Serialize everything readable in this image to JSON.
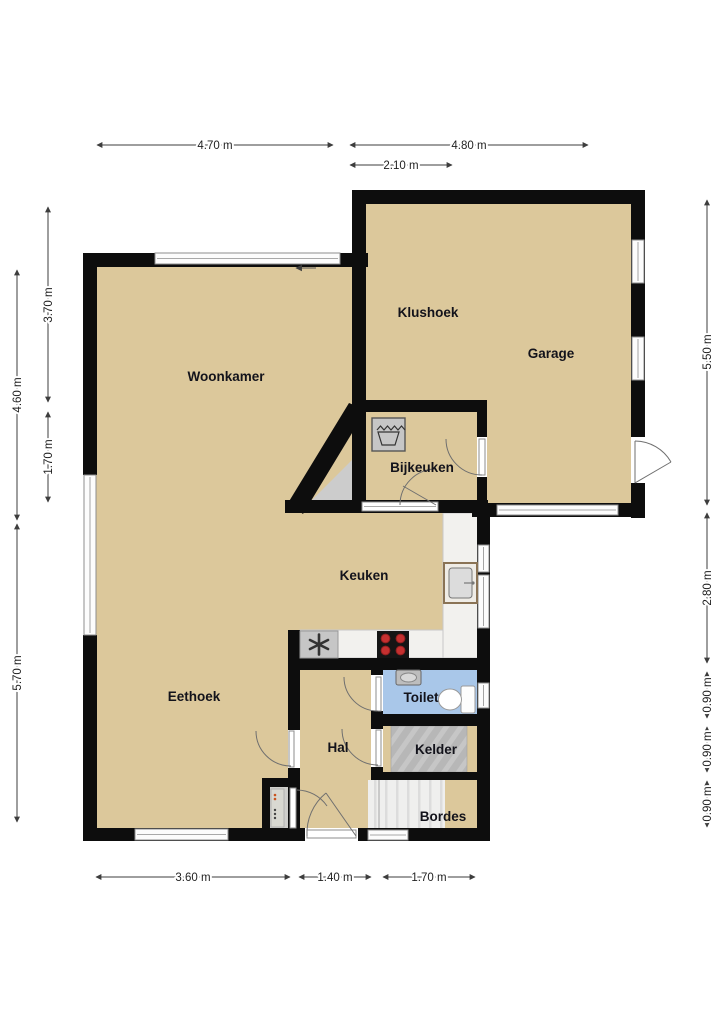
{
  "floor_plan": {
    "rooms": {
      "woonkamer": {
        "label": "Woonkamer"
      },
      "klushoek": {
        "label": "Klushoek"
      },
      "garage": {
        "label": "Garage"
      },
      "bijkeuken": {
        "label": "Bijkeuken"
      },
      "keuken": {
        "label": "Keuken"
      },
      "eethoek": {
        "label": "Eethoek"
      },
      "toilet": {
        "label": "Toilet"
      },
      "hal": {
        "label": "Hal"
      },
      "kelder": {
        "label": "Kelder"
      },
      "bordes": {
        "label": "Bordes"
      }
    },
    "dimensions": {
      "top": [
        {
          "label": "4.70 m"
        },
        {
          "label": "4.80 m"
        },
        {
          "label": "2.10 m"
        }
      ],
      "left_outer": [
        {
          "label": "4.60 m"
        },
        {
          "label": "5.70 m"
        }
      ],
      "left_inner": [
        {
          "label": "3.70 m"
        },
        {
          "label": "1.70 m"
        }
      ],
      "right": [
        {
          "label": "5.50 m"
        },
        {
          "label": "2.80 m"
        },
        {
          "label": "0.90 m"
        },
        {
          "label": "0.90 m"
        },
        {
          "label": "0.90 m"
        }
      ],
      "bottom": [
        {
          "label": "3.60 m"
        },
        {
          "label": "1.40 m"
        },
        {
          "label": "1.70 m"
        }
      ]
    },
    "icons": [
      "washing-machine",
      "extractor-fan",
      "cooktop",
      "kitchen-sink",
      "hand-basin",
      "toilet",
      "stairs-kelder",
      "stairs-bordes",
      "meter-cabinet"
    ],
    "colors": {
      "floor": "#dcc89b",
      "wall": "#0d0d0d",
      "toilet_floor": "#a9c7e9",
      "counter": "#f2f1ee",
      "stairs_gray": "#b7b7b7",
      "stairs_light": "#efefee",
      "burner_red": "#c53030",
      "window_frame": "#8e8e8e",
      "dimension_line": "#3d3d3d"
    }
  }
}
